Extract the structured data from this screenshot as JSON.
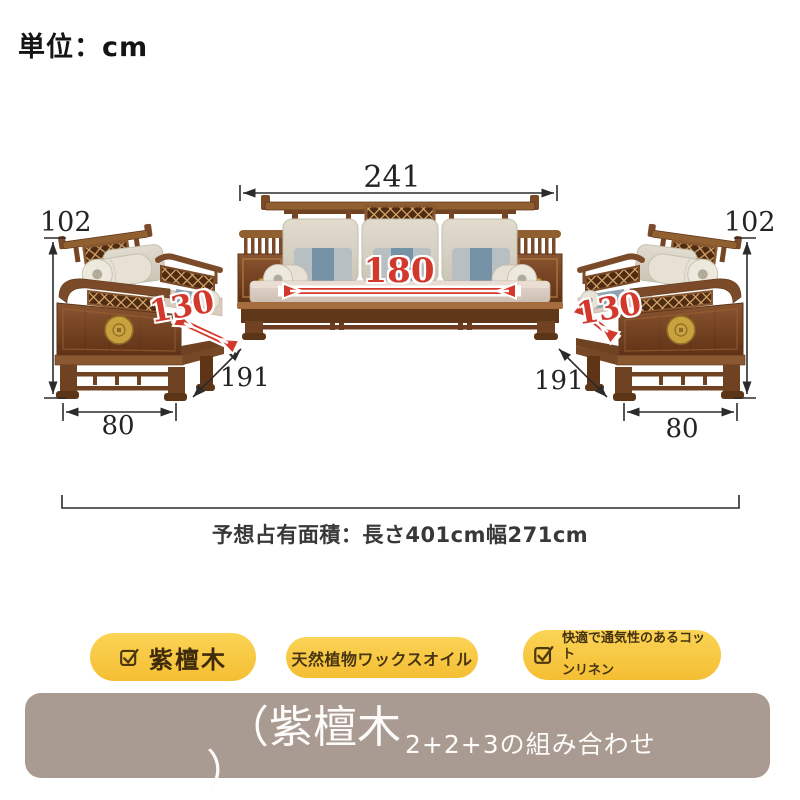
{
  "header": {
    "unit_label": "単位：cm"
  },
  "dimensions": {
    "sofa_3seat": {
      "width": "241",
      "seat_width": "180"
    },
    "side_sofa_left": {
      "height": "102",
      "seat_depth": "130",
      "depth": "191",
      "width": "80"
    },
    "side_sofa_right": {
      "height": "102",
      "seat_depth": "130",
      "depth": "191",
      "width": "80"
    }
  },
  "footprint": {
    "note": "予想占有面積：長さ401cm幅271cm"
  },
  "badges": [
    {
      "label": "紫檀木"
    },
    {
      "label": "天然植物ワックスオイル"
    },
    {
      "label_line1": "快適で通気性のあるコット",
      "label_line2": "ンリネン"
    }
  ],
  "footer_band": {
    "material_open": "（紫檀木",
    "material_close": "）",
    "combination": "2+2+3の組み合わせ"
  },
  "colors": {
    "dimension_red": "#d2382b",
    "badge_yellow": "#f6c63f",
    "band_taupe": "#a99b91",
    "wood_brown": "#7b4a28"
  }
}
